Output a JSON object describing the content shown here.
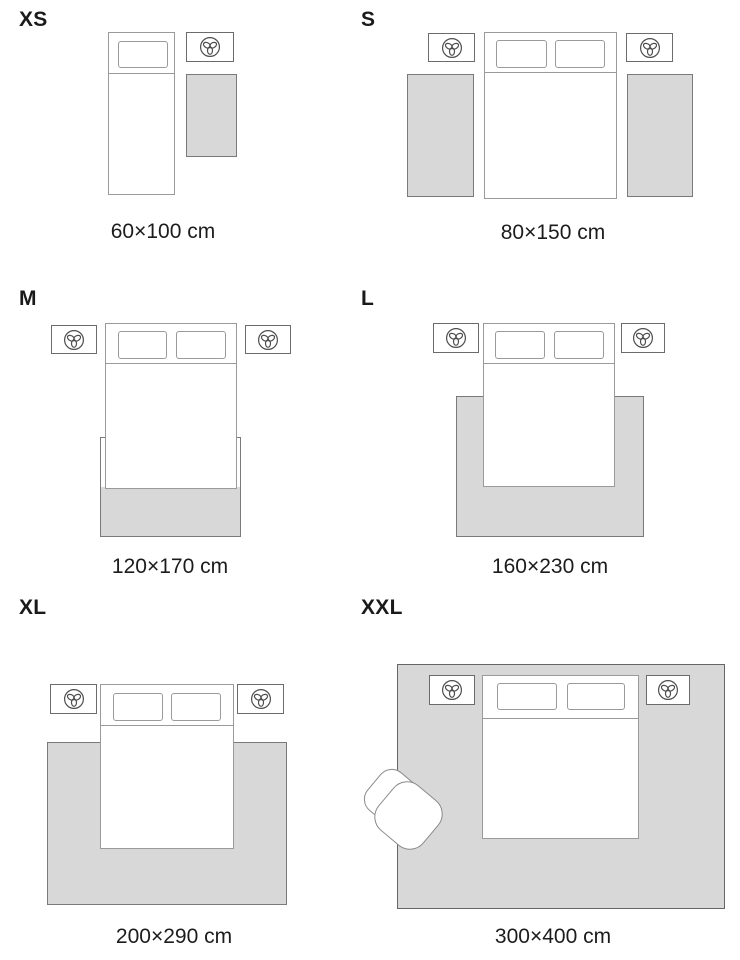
{
  "panels": [
    {
      "label": "XS",
      "caption": "60×100 cm"
    },
    {
      "label": "S",
      "caption": "80×150 cm"
    },
    {
      "label": "M",
      "caption": "120×170 cm"
    },
    {
      "label": "L",
      "caption": "160×230 cm"
    },
    {
      "label": "XL",
      "caption": "200×290 cm"
    },
    {
      "label": "XXL",
      "caption": "300×400 cm"
    }
  ],
  "icons": {
    "lamp": "table-lamp-icon"
  },
  "colors": {
    "background": "#ffffff",
    "rug_fill": "#d8d8d8",
    "rug_border": "#7a7a7a",
    "bed_stroke": "#9a9a9a",
    "nightstand_stroke": "#6b6b6b",
    "lamp_stroke": "#4d4d4d",
    "text": "#1a1a1a"
  }
}
